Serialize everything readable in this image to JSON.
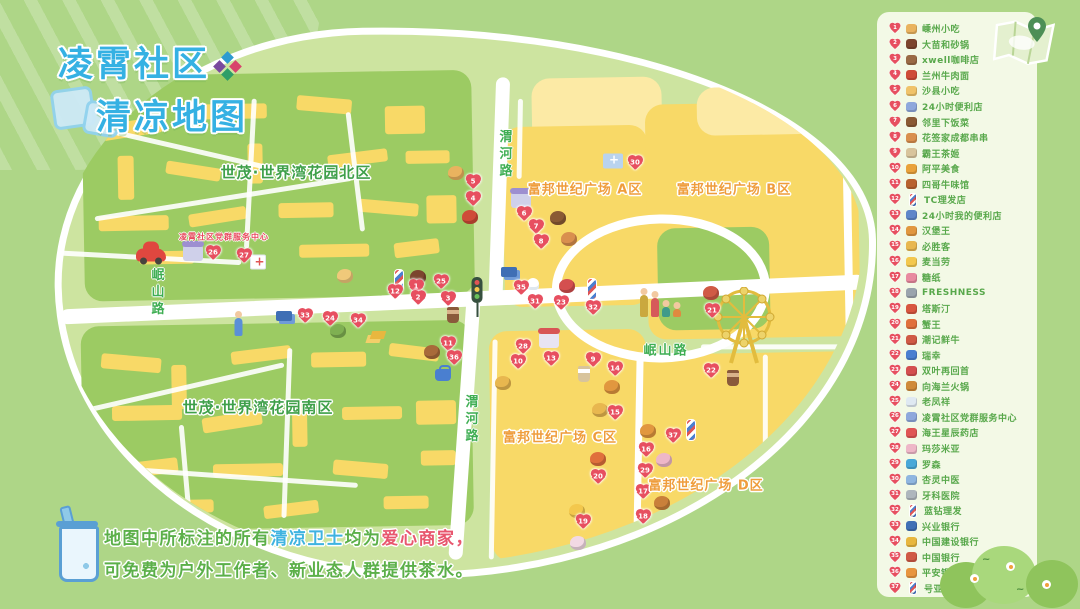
{
  "title": {
    "line1": "凌霄社区",
    "line2": "清凉地图"
  },
  "note": {
    "line1_segments": [
      {
        "text": "地图中所标注的所有",
        "color": "green"
      },
      {
        "text": "清凉卫士",
        "color": "blue"
      },
      {
        "text": "均为",
        "color": "green"
      },
      {
        "text": "爱心商家",
        "color": "pink"
      },
      {
        "text": "，",
        "color": "pink"
      }
    ],
    "line2": "可免费为户外工作者、新业态人群提供茶水。"
  },
  "colors": {
    "background": "#aed687",
    "map_base": "#cde4a0",
    "block_yellow": "#f8d967",
    "block_green": "#9ccb63",
    "heart_red": "#e74f60",
    "title_blue": "#35b1e3",
    "label_green": "#3fa04a",
    "label_orange": "#ef9d3c",
    "legend_text_green": "#58a84b",
    "note_pink": "#e8566e"
  },
  "legend": {
    "items": [
      {
        "n": 1,
        "label": "嵊州小吃",
        "icon": "steamer-basket"
      },
      {
        "n": 2,
        "label": "大苗和砂锅",
        "icon": "clay-pot"
      },
      {
        "n": 3,
        "label": "xwell咖啡店",
        "icon": "coffee-cup"
      },
      {
        "n": 4,
        "label": "兰州牛肉面",
        "icon": "noodle-bowl"
      },
      {
        "n": 5,
        "label": "沙县小吃",
        "icon": "snack-plate"
      },
      {
        "n": 6,
        "label": "24小时便利店",
        "icon": "store-cube"
      },
      {
        "n": 7,
        "label": "邻里下饭菜",
        "icon": "home-dish"
      },
      {
        "n": 8,
        "label": "花签家成都串串",
        "icon": "skewers"
      },
      {
        "n": 9,
        "label": "霸王茶姬",
        "icon": "milk-tea"
      },
      {
        "n": 10,
        "label": "阿平美食",
        "icon": "food-plate"
      },
      {
        "n": 11,
        "label": "四哥牛味馆",
        "icon": "beef-bowl"
      },
      {
        "n": 12,
        "label": "TC理发店",
        "icon": "barber-pole"
      },
      {
        "n": 13,
        "label": "24小时我的便利店",
        "icon": "store-books"
      },
      {
        "n": 14,
        "label": "汉堡王",
        "icon": "burger"
      },
      {
        "n": 15,
        "label": "必胜客",
        "icon": "pizza"
      },
      {
        "n": 16,
        "label": "麦当劳",
        "icon": "fries"
      },
      {
        "n": 17,
        "label": "糖纸",
        "icon": "candy"
      },
      {
        "n": 18,
        "label": "FRESHNESS",
        "icon": "fresh-cup"
      },
      {
        "n": 19,
        "label": "塔斯汀",
        "icon": "burger-red"
      },
      {
        "n": 20,
        "label": "蟹王",
        "icon": "crab"
      },
      {
        "n": 21,
        "label": "潮记鲜牛",
        "icon": "beef-plate"
      },
      {
        "n": 22,
        "label": "瑞幸",
        "icon": "coffee-blue"
      },
      {
        "n": 23,
        "label": "双叶再回首",
        "icon": "liangpi-dish"
      },
      {
        "n": 24,
        "label": "向海兰火锅",
        "icon": "hotpot"
      },
      {
        "n": 25,
        "label": "老凤祥",
        "icon": "diamond"
      },
      {
        "n": 26,
        "label": "凌霄社区党群服务中心",
        "icon": "gov-building"
      },
      {
        "n": 27,
        "label": "海王星辰药店",
        "icon": "pharmacy-cross"
      },
      {
        "n": 28,
        "label": "玛莎米亚",
        "icon": "cake"
      },
      {
        "n": 29,
        "label": "罗森",
        "icon": "store-front"
      },
      {
        "n": 30,
        "label": "杏灵中医",
        "icon": "tcm-clinic"
      },
      {
        "n": 31,
        "label": "牙科医院",
        "icon": "dental-tools"
      },
      {
        "n": 32,
        "label": "蓝钻理发",
        "icon": "barber-pole"
      },
      {
        "n": 33,
        "label": "兴业银行",
        "icon": "bank-card-blue"
      },
      {
        "n": 34,
        "label": "中国建设银行",
        "icon": "bank-gold"
      },
      {
        "n": 35,
        "label": "中国银行",
        "icon": "bank-card-red"
      },
      {
        "n": 36,
        "label": "平安银行",
        "icon": "bank-bag"
      },
      {
        "n": 37,
        "label": "号亚伦理发",
        "icon": "barber-pole"
      }
    ]
  },
  "map": {
    "area_labels": [
      {
        "text": "世茂·世界湾花园北区",
        "color": "green",
        "x": 296,
        "y": 172,
        "size": 15
      },
      {
        "text": "世茂·世界湾花园南区",
        "color": "green",
        "x": 258,
        "y": 407,
        "size": 15
      },
      {
        "text": "富邦世纪广场 A区",
        "color": "orange",
        "x": 585,
        "y": 188,
        "size": 13
      },
      {
        "text": "富邦世纪广场 B区",
        "color": "orange",
        "x": 734,
        "y": 188,
        "size": 13
      },
      {
        "text": "富邦世纪广场 C区",
        "color": "orange",
        "x": 560,
        "y": 436,
        "size": 13
      },
      {
        "text": "富邦世纪广场 D区",
        "color": "orange",
        "x": 706,
        "y": 484,
        "size": 13
      },
      {
        "text": "凌霄社区党群服务中心",
        "color": "red",
        "x": 224,
        "y": 237,
        "size": 8
      }
    ],
    "road_labels": [
      {
        "text": "渭河路",
        "x": 504,
        "y": 155,
        "vertical": true
      },
      {
        "text": "渭河路",
        "x": 470,
        "y": 420,
        "vertical": true
      },
      {
        "text": "岷山路",
        "x": 156,
        "y": 293,
        "vertical": true
      },
      {
        "text": "岷山路",
        "x": 666,
        "y": 349,
        "vertical": false
      }
    ],
    "markers": [
      {
        "n": 1,
        "x": 416,
        "y": 287
      },
      {
        "n": 2,
        "x": 418,
        "y": 298
      },
      {
        "n": 3,
        "x": 448,
        "y": 299
      },
      {
        "n": 4,
        "x": 473,
        "y": 199
      },
      {
        "n": 5,
        "x": 473,
        "y": 182
      },
      {
        "n": 6,
        "x": 524,
        "y": 214
      },
      {
        "n": 7,
        "x": 536,
        "y": 227
      },
      {
        "n": 8,
        "x": 541,
        "y": 242
      },
      {
        "n": 9,
        "x": 593,
        "y": 360
      },
      {
        "n": 10,
        "x": 518,
        "y": 362
      },
      {
        "n": 11,
        "x": 448,
        "y": 344
      },
      {
        "n": 12,
        "x": 395,
        "y": 292
      },
      {
        "n": 13,
        "x": 551,
        "y": 359
      },
      {
        "n": 14,
        "x": 615,
        "y": 369
      },
      {
        "n": 15,
        "x": 615,
        "y": 413
      },
      {
        "n": 16,
        "x": 646,
        "y": 450
      },
      {
        "n": 17,
        "x": 643,
        "y": 492
      },
      {
        "n": 18,
        "x": 643,
        "y": 517
      },
      {
        "n": 19,
        "x": 583,
        "y": 522
      },
      {
        "n": 20,
        "x": 598,
        "y": 477
      },
      {
        "n": 21,
        "x": 712,
        "y": 311
      },
      {
        "n": 22,
        "x": 711,
        "y": 371
      },
      {
        "n": 23,
        "x": 561,
        "y": 303
      },
      {
        "n": 24,
        "x": 330,
        "y": 319
      },
      {
        "n": 25,
        "x": 441,
        "y": 282
      },
      {
        "n": 26,
        "x": 213,
        "y": 253
      },
      {
        "n": 27,
        "x": 244,
        "y": 256
      },
      {
        "n": 28,
        "x": 523,
        "y": 347
      },
      {
        "n": 29,
        "x": 645,
        "y": 471
      },
      {
        "n": 30,
        "x": 635,
        "y": 163
      },
      {
        "n": 31,
        "x": 535,
        "y": 302
      },
      {
        "n": 32,
        "x": 593,
        "y": 308
      },
      {
        "n": 33,
        "x": 305,
        "y": 316
      },
      {
        "n": 34,
        "x": 358,
        "y": 321
      },
      {
        "n": 35,
        "x": 521,
        "y": 288
      },
      {
        "n": 36,
        "x": 454,
        "y": 358
      },
      {
        "n": 37,
        "x": 673,
        "y": 436
      }
    ],
    "icons": [
      {
        "name": "red-car",
        "x": 151,
        "y": 255
      },
      {
        "name": "community-building",
        "x": 193,
        "y": 253
      },
      {
        "name": "pharmacy-store",
        "x": 258,
        "y": 262
      },
      {
        "name": "bakery-cake",
        "x": 345,
        "y": 276
      },
      {
        "name": "barber-pole",
        "x": 399,
        "y": 280
      },
      {
        "name": "clay-pot-dish",
        "x": 418,
        "y": 277
      },
      {
        "name": "traffic-light",
        "x": 477,
        "y": 290
      },
      {
        "name": "coffee-cup",
        "x": 453,
        "y": 315
      },
      {
        "name": "steamer-basket",
        "x": 456,
        "y": 173
      },
      {
        "name": "noodle-bowl",
        "x": 470,
        "y": 217
      },
      {
        "name": "store-purple",
        "x": 521,
        "y": 200
      },
      {
        "name": "braised-dish",
        "x": 558,
        "y": 218
      },
      {
        "name": "skewers",
        "x": 569,
        "y": 239
      },
      {
        "name": "clinic-building",
        "x": 613,
        "y": 161
      },
      {
        "name": "bank-cards",
        "x": 509,
        "y": 272
      },
      {
        "name": "tooth",
        "x": 533,
        "y": 284
      },
      {
        "name": "liangpi-dish",
        "x": 567,
        "y": 286
      },
      {
        "name": "barber-pole",
        "x": 592,
        "y": 289
      },
      {
        "name": "family",
        "x": 660,
        "y": 303
      },
      {
        "name": "beef-plate",
        "x": 711,
        "y": 293
      },
      {
        "name": "ferris-wheel",
        "x": 744,
        "y": 328
      },
      {
        "name": "girl",
        "x": 238,
        "y": 324
      },
      {
        "name": "bank-card-blue",
        "x": 284,
        "y": 316
      },
      {
        "name": "salad-bowl",
        "x": 338,
        "y": 331
      },
      {
        "name": "gold-bars",
        "x": 371,
        "y": 331
      },
      {
        "name": "cookie-dish",
        "x": 432,
        "y": 352
      },
      {
        "name": "briefcase",
        "x": 443,
        "y": 375
      },
      {
        "name": "pizza-donut",
        "x": 503,
        "y": 383
      },
      {
        "name": "store-red",
        "x": 549,
        "y": 340
      },
      {
        "name": "milk-tea-cup",
        "x": 584,
        "y": 374
      },
      {
        "name": "burger",
        "x": 612,
        "y": 387
      },
      {
        "name": "pizza",
        "x": 600,
        "y": 410
      },
      {
        "name": "coffee-cup",
        "x": 733,
        "y": 378
      },
      {
        "name": "burger",
        "x": 648,
        "y": 431
      },
      {
        "name": "barber-pole",
        "x": 691,
        "y": 430
      },
      {
        "name": "cake",
        "x": 664,
        "y": 460
      },
      {
        "name": "seafood-plate",
        "x": 598,
        "y": 459
      },
      {
        "name": "fries",
        "x": 577,
        "y": 511
      },
      {
        "name": "fish-dish",
        "x": 662,
        "y": 503
      },
      {
        "name": "icecream",
        "x": 578,
        "y": 543
      }
    ]
  }
}
